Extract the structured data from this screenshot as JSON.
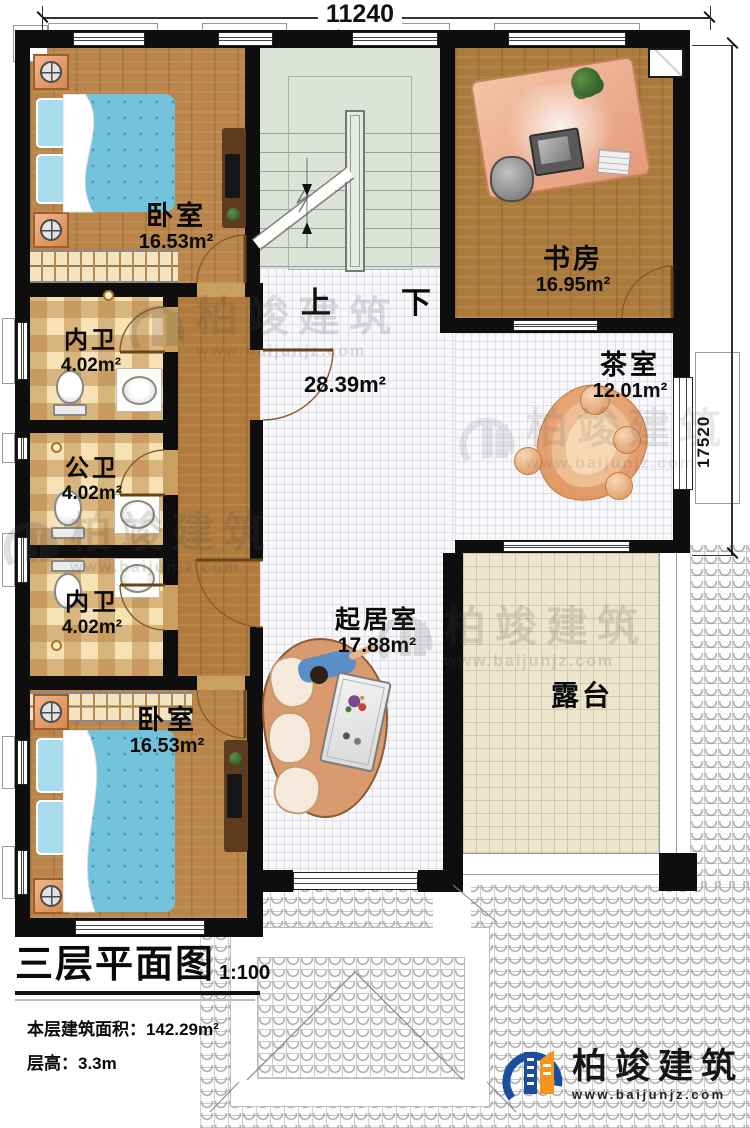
{
  "plan": {
    "dimension_top": "11240",
    "dimension_right": "17520",
    "stair_up": "上",
    "stair_down": "下",
    "hall_area": "28.39m²",
    "rooms": {
      "bedroom_top": {
        "name": "卧室",
        "area": "16.53m²"
      },
      "study": {
        "name": "书房",
        "area": "16.95m²"
      },
      "tea_room": {
        "name": "茶室",
        "area": "12.01m²"
      },
      "bath_inner_top": {
        "name": "内卫",
        "area": "4.02m²"
      },
      "bath_public": {
        "name": "公卫",
        "area": "4.02m²"
      },
      "bath_inner_bottom": {
        "name": "内卫",
        "area": "4.02m²"
      },
      "living_room": {
        "name": "起居室",
        "area": "17.88m²"
      },
      "bedroom_bottom": {
        "name": "卧室",
        "area": "16.53m²"
      },
      "terrace": {
        "name": "露台"
      }
    }
  },
  "title_block": {
    "title": "三层平面图",
    "scale": "1:100",
    "building_area": "本层建筑面积：142.29m²",
    "floor_height": "层高：3.3m"
  },
  "brand": {
    "name": "柏竣建筑",
    "website": "www.baijunjz.com"
  },
  "watermark": {
    "name": "柏竣建筑",
    "website": "www.baijunjz.com"
  },
  "colors": {
    "wall": "#0e0e0e",
    "wood_floor": "#b9854a",
    "bath_tile": "#f0d9a6",
    "stair": "#dde3d8",
    "terrace": "#ebe6cd",
    "bed_blue": "#74c3dd",
    "desk_salmon": "#eeab8b",
    "logo_blue": "#1b4f9e",
    "logo_orange": "#f7941d"
  }
}
